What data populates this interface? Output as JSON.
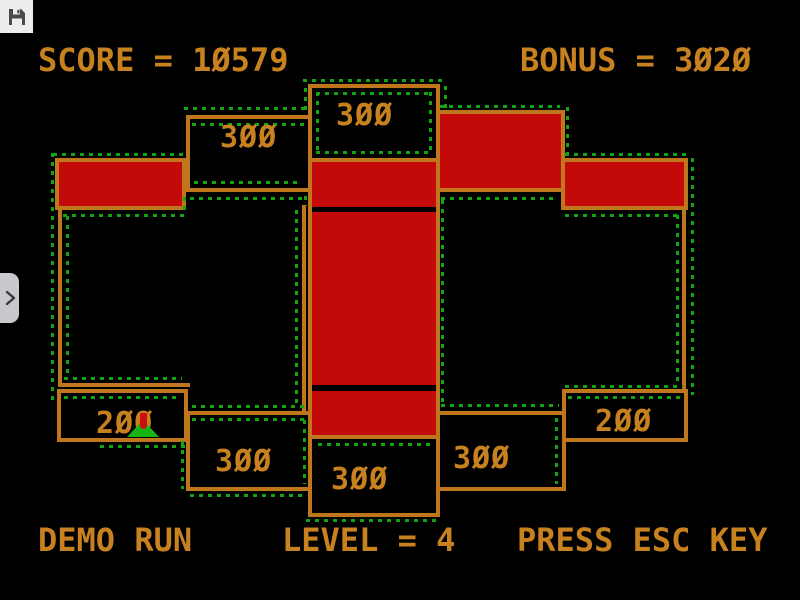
{
  "overlay": {
    "save_tile": {
      "icon": "floppy-disk-icon"
    },
    "side_toggle": {
      "icon": "chevron-right-icon"
    }
  },
  "hud": {
    "score_text": "SCORE = 10579",
    "score_value": 10579,
    "bonus_text": "BONUS = 3020",
    "bonus_value": 3020,
    "demo_text": "DEMO RUN",
    "level_text": "LEVEL = 4",
    "level_value": 4,
    "prompt_text": "PRESS ESC KEY"
  },
  "playfield": {
    "labels": {
      "top_center": "300",
      "top_left": "300",
      "bottom_left_small": "200",
      "bottom_left": "300",
      "bottom_center": "300",
      "bottom_right": "300",
      "bottom_right_small": "200"
    },
    "player": {
      "type": "green-splat-with-red-drip",
      "x": 143,
      "y": 429
    },
    "colors": {
      "claimed_fill": "#c40909",
      "border": "#c0761d",
      "text": "#c8811f",
      "trace_dots": "#12a412",
      "player_green": "#17b417",
      "player_red": "#cc1010"
    }
  }
}
